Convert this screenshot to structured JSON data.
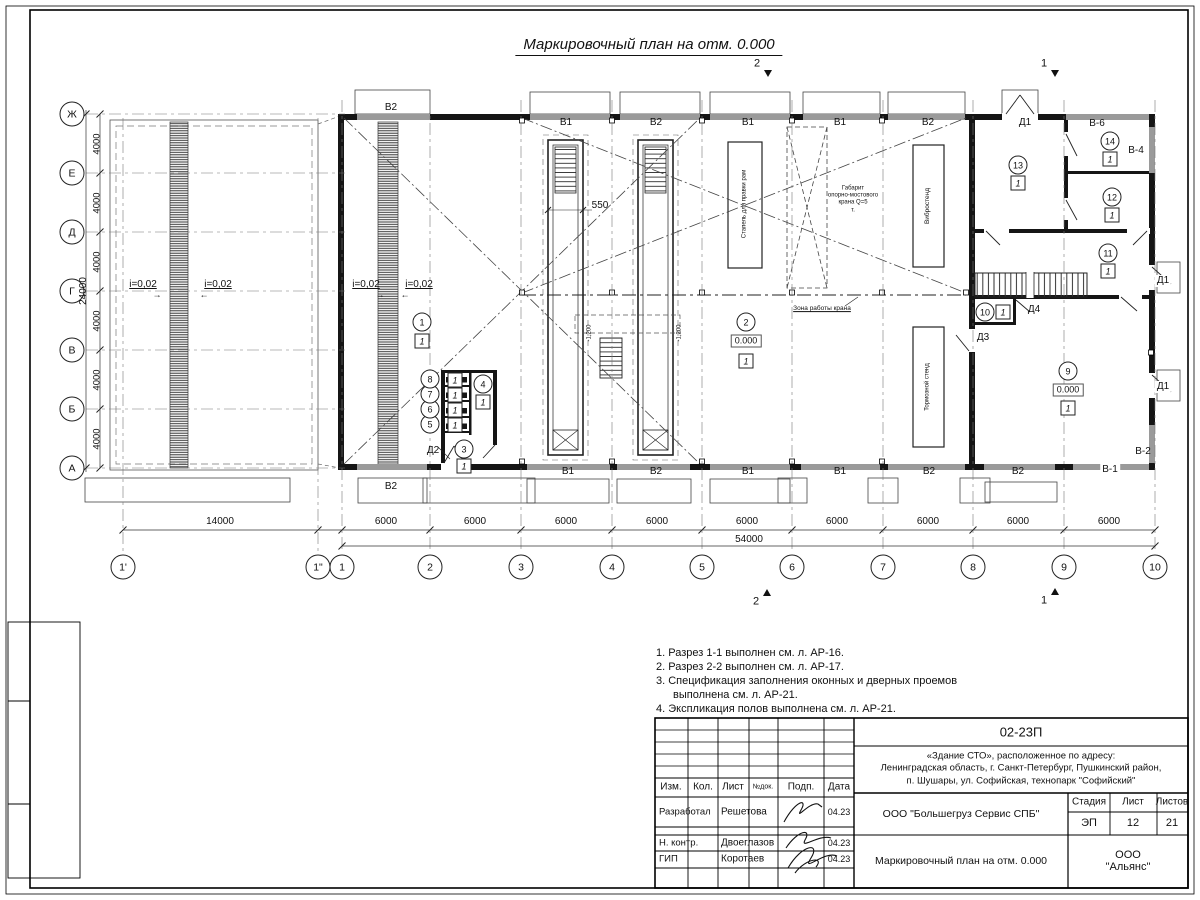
{
  "sheet": {
    "title": "Маркировочный план на отм. 0.000",
    "notes": [
      "1. Разрез 1-1 выполнен см. л. АР-16.",
      "2. Разрез 2-2 выполнен см. л. АР-17.",
      "3. Спецификация заполнения оконных и дверных проемов выполнена см. л. АР-21.",
      "4. Экспликация полов выполнена см. л. АР-21."
    ]
  },
  "grid": {
    "rows": [
      {
        "label": "Ж",
        "y": 114
      },
      {
        "label": "Е",
        "y": 173
      },
      {
        "label": "Д",
        "y": 232
      },
      {
        "label": "Г",
        "y": 291
      },
      {
        "label": "В",
        "y": 350
      },
      {
        "label": "Б",
        "y": 409
      },
      {
        "label": "А",
        "y": 468
      }
    ],
    "cols": [
      {
        "label": "1'",
        "x": 123
      },
      {
        "label": "1\"",
        "x": 318
      },
      {
        "label": "1",
        "x": 342
      },
      {
        "label": "2",
        "x": 430
      },
      {
        "label": "3",
        "x": 521
      },
      {
        "label": "4",
        "x": 612
      },
      {
        "label": "5",
        "x": 702
      },
      {
        "label": "6",
        "x": 792
      },
      {
        "label": "7",
        "x": 883
      },
      {
        "label": "8",
        "x": 973
      },
      {
        "label": "9",
        "x": 1064
      },
      {
        "label": "10",
        "x": 1155
      }
    ],
    "row_dims": [
      {
        "text": "4000",
        "y": 143.5
      },
      {
        "text": "4000",
        "y": 202.5
      },
      {
        "text": "4000",
        "y": 261.5
      },
      {
        "text": "4000",
        "y": 320.5
      },
      {
        "text": "4000",
        "y": 379.5
      },
      {
        "text": "4000",
        "y": 438.5
      }
    ],
    "row_total": {
      "text": "24000",
      "x": 84,
      "y": 291
    },
    "col_dims": [
      {
        "text": "14000",
        "x": 220
      },
      {
        "text": "6000",
        "x": 386
      },
      {
        "text": "6000",
        "x": 475
      },
      {
        "text": "6000",
        "x": 566
      },
      {
        "text": "6000",
        "x": 657
      },
      {
        "text": "6000",
        "x": 747
      },
      {
        "text": "6000",
        "x": 837
      },
      {
        "text": "6000",
        "x": 928
      },
      {
        "text": "6000",
        "x": 1018
      },
      {
        "text": "6000",
        "x": 1109
      }
    ],
    "col_total": {
      "text": "54000",
      "x": 749,
      "y": 540
    }
  },
  "plan": {
    "floor_mark": "1",
    "labels": [
      {
        "t": "В2",
        "x": 391,
        "y": 108
      },
      {
        "t": "В1",
        "x": 566,
        "y": 123
      },
      {
        "t": "В2",
        "x": 656,
        "y": 123
      },
      {
        "t": "В1",
        "x": 748,
        "y": 123
      },
      {
        "t": "В1",
        "x": 840,
        "y": 123
      },
      {
        "t": "В2",
        "x": 928,
        "y": 123
      },
      {
        "t": "Д1",
        "x": 1025,
        "y": 123
      },
      {
        "t": "В-6",
        "x": 1097,
        "y": 124
      },
      {
        "t": "В-4",
        "x": 1136,
        "y": 151
      },
      {
        "t": "В2",
        "x": 391,
        "y": 487
      },
      {
        "t": "В1",
        "x": 568,
        "y": 472
      },
      {
        "t": "В2",
        "x": 656,
        "y": 472
      },
      {
        "t": "В1",
        "x": 748,
        "y": 472
      },
      {
        "t": "В1",
        "x": 840,
        "y": 472
      },
      {
        "t": "В2",
        "x": 929,
        "y": 472
      },
      {
        "t": "В2",
        "x": 1018,
        "y": 472
      },
      {
        "t": "В-1",
        "x": 1110,
        "y": 470,
        "bg": true
      },
      {
        "t": "В-2",
        "x": 1143,
        "y": 452
      },
      {
        "t": "Д2",
        "x": 433,
        "y": 451
      },
      {
        "t": "Д3",
        "x": 983,
        "y": 338
      },
      {
        "t": "Д4",
        "x": 1034,
        "y": 310
      },
      {
        "t": "Д1",
        "x": 1163,
        "y": 281,
        "bg": true
      },
      {
        "t": "Д1",
        "x": 1163,
        "y": 387,
        "bg": true
      },
      {
        "t": "550",
        "x": 600,
        "y": 206
      },
      {
        "t": "Зона работы крана",
        "x": 822,
        "y": 309,
        "fs": 6.5,
        "ul": true
      }
    ],
    "vlabels": [
      {
        "t": "Стапель для правки рам",
        "x": 745,
        "y": 204,
        "fs": 6
      },
      {
        "t": "Вибростенд",
        "x": 928,
        "y": 206,
        "fs": 6.5
      },
      {
        "t": "Тормозной стенд",
        "x": 928,
        "y": 387,
        "fs": 6
      },
      {
        "t": "-1,200",
        "x": 590,
        "y": 333,
        "fs": 6
      },
      {
        "t": "-1,200",
        "x": 680,
        "y": 333,
        "fs": 6
      }
    ],
    "multiline": [
      {
        "t": "Габарит\nопорно-мостового\nкрана Q=5\nт.",
        "x": 853,
        "y": 200,
        "fs": 6
      }
    ],
    "slopes": [
      {
        "t": "i=0,02",
        "x": 143,
        "y": 285,
        "a": "→",
        "ax": 157,
        "ay": 295
      },
      {
        "t": "i=0,02",
        "x": 218,
        "y": 285,
        "a": "←",
        "ax": 204,
        "ay": 295
      },
      {
        "t": "i=0,02",
        "x": 366,
        "y": 285,
        "a": "→",
        "ax": 380,
        "ay": 295
      },
      {
        "t": "i=0,02",
        "x": 419,
        "y": 285,
        "a": "←",
        "ax": 405,
        "ay": 295
      }
    ],
    "sections": [
      {
        "t": "2",
        "x": 757,
        "y": 64,
        "tx": 764,
        "ty": 70,
        "dir": "down"
      },
      {
        "t": "1",
        "x": 1044,
        "y": 64,
        "tx": 1051,
        "ty": 70,
        "dir": "down"
      },
      {
        "t": "2",
        "x": 756,
        "y": 602,
        "tx": 763,
        "ty": 589,
        "dir": "up"
      },
      {
        "t": "1",
        "x": 1044,
        "y": 601,
        "tx": 1051,
        "ty": 588,
        "dir": "up"
      }
    ],
    "rooms": [
      {
        "n": "1",
        "x": 422,
        "y": 322,
        "bx": 422,
        "by": 341
      },
      {
        "n": "2",
        "x": 746,
        "y": 322,
        "elev": "0.000",
        "ex": 746,
        "ey": 341,
        "bx": 746,
        "by": 361
      },
      {
        "n": "3",
        "x": 464,
        "y": 449,
        "bx": 464,
        "by": 466
      },
      {
        "n": "4",
        "x": 483,
        "y": 384,
        "bx": 483,
        "by": 402
      },
      {
        "n": "5",
        "x": 430,
        "y": 424,
        "bx": 455,
        "by": 425
      },
      {
        "n": "6",
        "x": 430,
        "y": 409,
        "bx": 455,
        "by": 410
      },
      {
        "n": "7",
        "x": 430,
        "y": 394,
        "bx": 455,
        "by": 395
      },
      {
        "n": "8",
        "x": 430,
        "y": 379,
        "bx": 455,
        "by": 380
      },
      {
        "n": "9",
        "x": 1068,
        "y": 371,
        "elev": "0.000",
        "ex": 1068,
        "ey": 390,
        "bx": 1068,
        "by": 408
      },
      {
        "n": "10",
        "x": 985,
        "y": 312,
        "bx": 1003,
        "by": 312
      },
      {
        "n": "11",
        "x": 1108,
        "y": 253,
        "bx": 1108,
        "by": 271
      },
      {
        "n": "12",
        "x": 1112,
        "y": 197,
        "bx": 1112,
        "by": 215
      },
      {
        "n": "13",
        "x": 1018,
        "y": 165,
        "bx": 1018,
        "by": 183
      },
      {
        "n": "14",
        "x": 1110,
        "y": 141,
        "bx": 1110,
        "by": 159
      }
    ]
  },
  "tb": {
    "doc_number": "02-23П",
    "project": "«Здание СТО», расположенное по адресу:\nЛенинградская область, г. Санкт-Петербург, Пушкинский район,\nп. Шушары, ул. Софийская, технопарк \"Софийский\"",
    "company": "ООО \"Большегруз Сервис СПБ\"",
    "sheet_title": "Маркировочный план на отм. 0.000",
    "org": "ООО \"Альянс\"",
    "stage_label": "Стадия",
    "sheet_label": "Лист",
    "sheets_label": "Листов",
    "stage": "ЭП",
    "sheet": "12",
    "sheets": "21",
    "cols": [
      "Изм.",
      "Кол.",
      "Лист",
      "№док.",
      "Подп.",
      "Дата"
    ],
    "rows": [
      {
        "role": "Разработал",
        "name": "Решетова",
        "date": "04.23"
      },
      {
        "role": "Н. контр.",
        "name": "Двоеглазов",
        "date": "04.23"
      },
      {
        "role": "ГИП",
        "name": "Коротаев",
        "date": "04.23"
      }
    ]
  }
}
